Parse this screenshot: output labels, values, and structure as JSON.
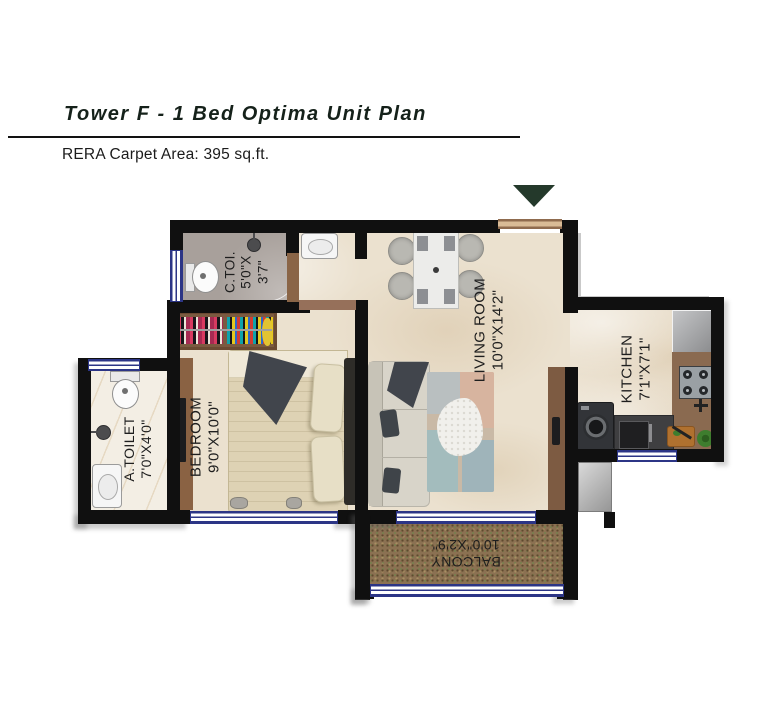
{
  "header": {
    "title": "Tower F - 1 Bed Optima Unit Plan",
    "subtitle": "RERA Carpet Area: 395 sq.ft."
  },
  "rooms": {
    "ctoi": {
      "name": "C.TOI.",
      "dim1": "5'0\"X",
      "dim2": "3'7\""
    },
    "living": {
      "name": "LIVING ROOM",
      "dims": "10'0\"X14'2\""
    },
    "kitchen": {
      "name": "KITCHEN",
      "dims": "7'1\"X7'1\""
    },
    "bedroom": {
      "name": "BEDROOM",
      "dims": "9'0\"X10'0\""
    },
    "atoilet": {
      "name": "A.TOILET",
      "dims": "7'0\"X4'0\""
    },
    "balcony": {
      "name": "BALCONY",
      "dims": "10'0\"X2'9\""
    }
  },
  "colors": {
    "wall": "#101010",
    "door_brown": "#8a6547",
    "window_stripe": "#2c3586",
    "entry_arrow_green": "#24392b",
    "balcony_floor": "#8b7152",
    "floor_beige": "#ebe1cf",
    "ctoi_floor_gray": "#a8a09b"
  }
}
